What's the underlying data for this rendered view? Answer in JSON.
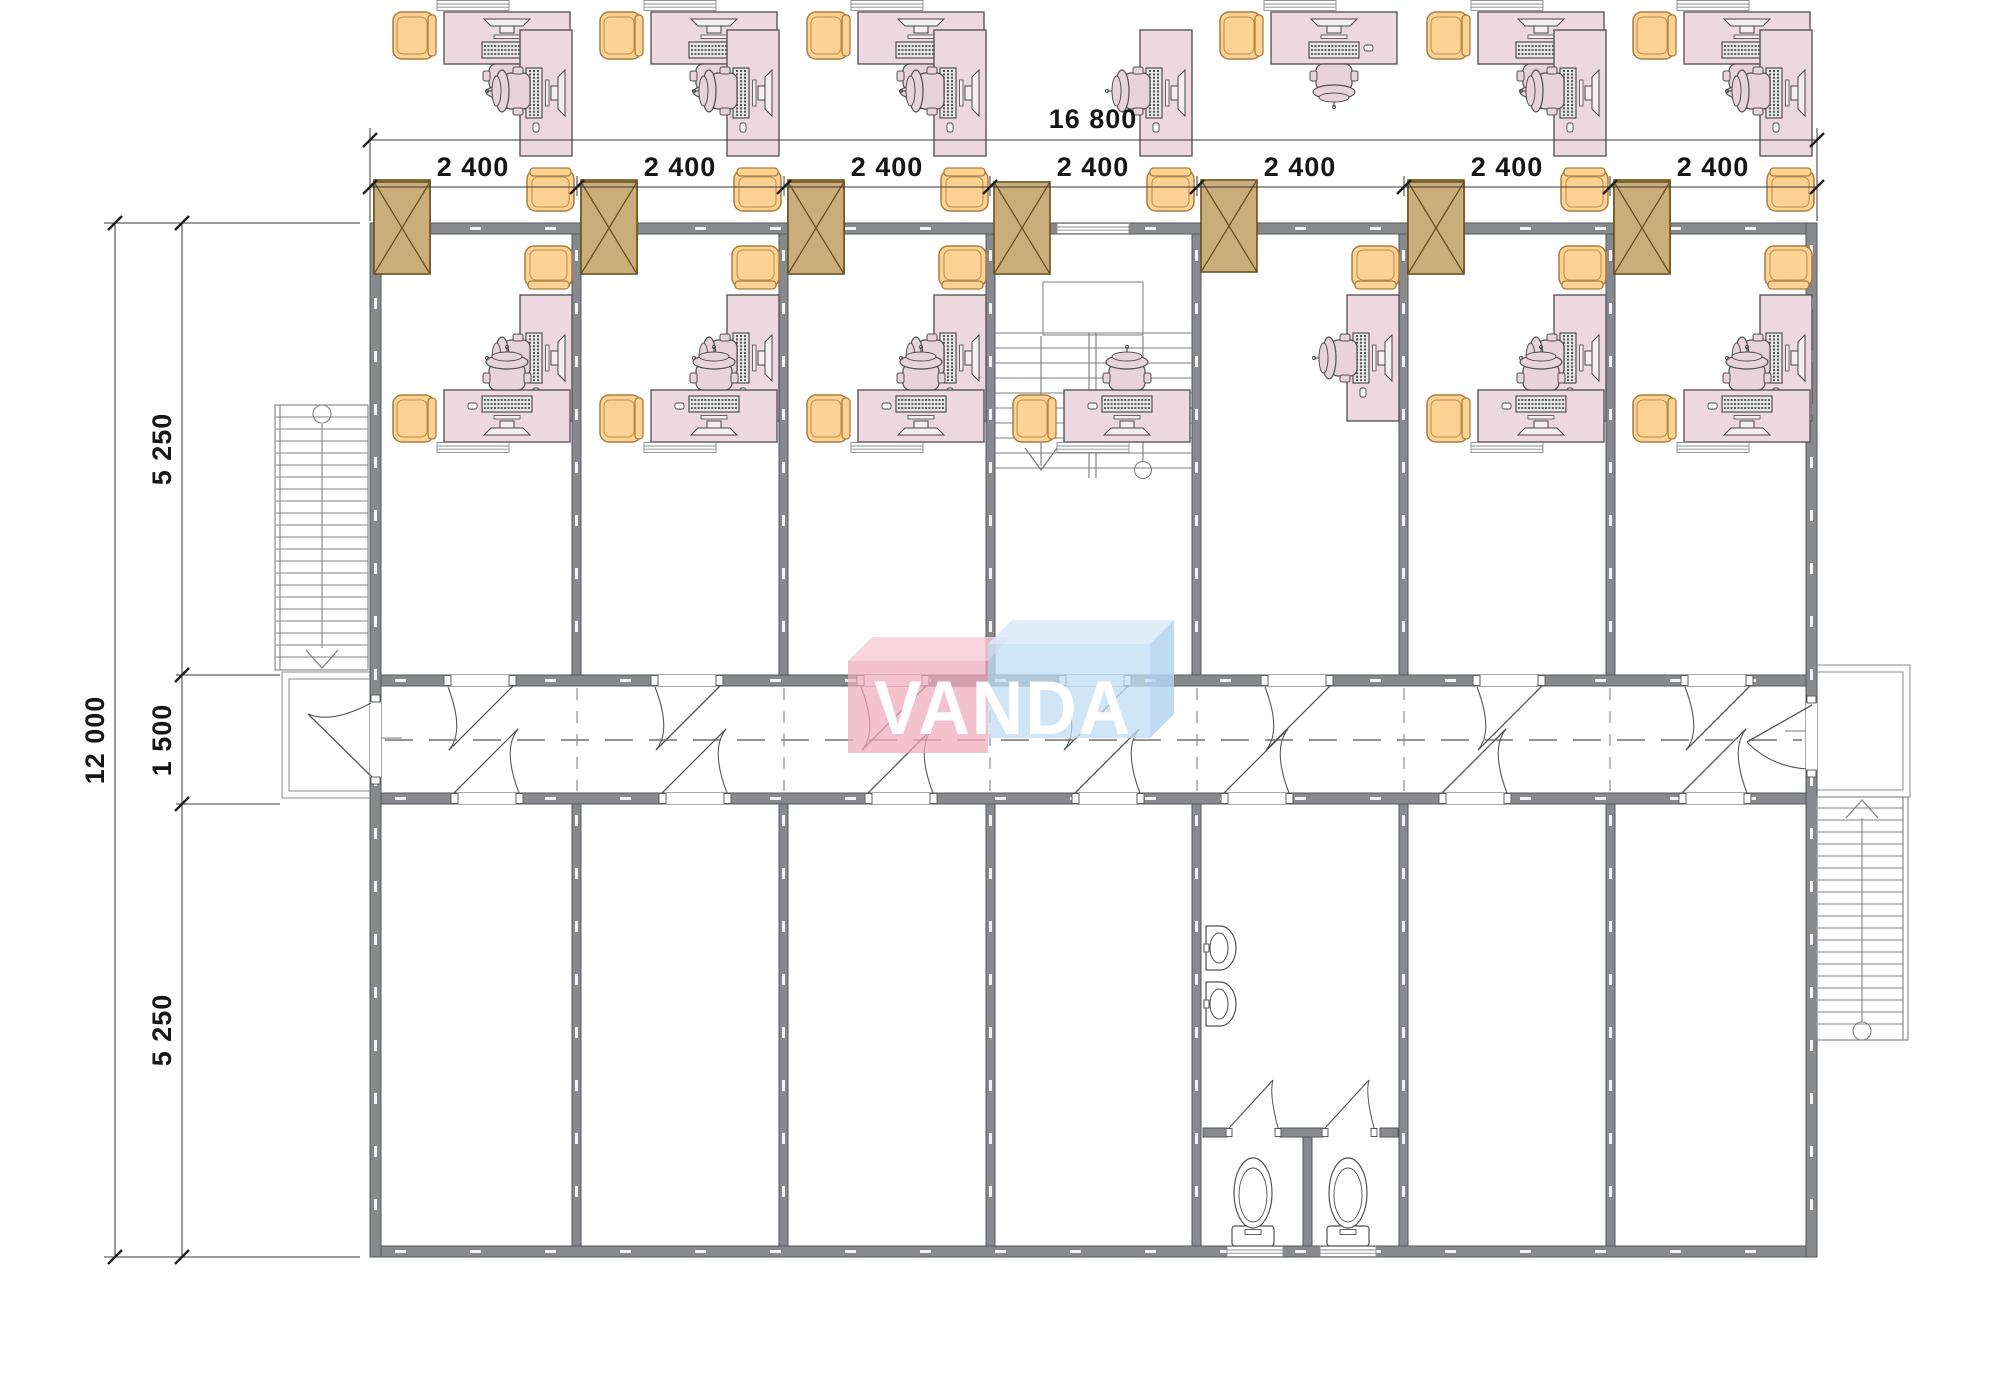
{
  "drawing": {
    "watermark": "VANDA",
    "dimensions": {
      "top_total": "16 800",
      "top_bays": [
        "2 400",
        "2 400",
        "2 400",
        "2 400",
        "2 400",
        "2 400",
        "2 400"
      ],
      "left_total": "12 000",
      "left_top": "5 250",
      "left_middle": "1 500",
      "left_bottom": "5 250"
    },
    "colors": {
      "wall": "#87898c",
      "desk": "#ecd8de",
      "office_chair": "#e8d3da",
      "armchair": "#fcd191",
      "cabinet": "#cbad79",
      "logo_pink": "#f0a9bc",
      "logo_blue": "#c0dcf2",
      "line": "#6f7173"
    }
  }
}
